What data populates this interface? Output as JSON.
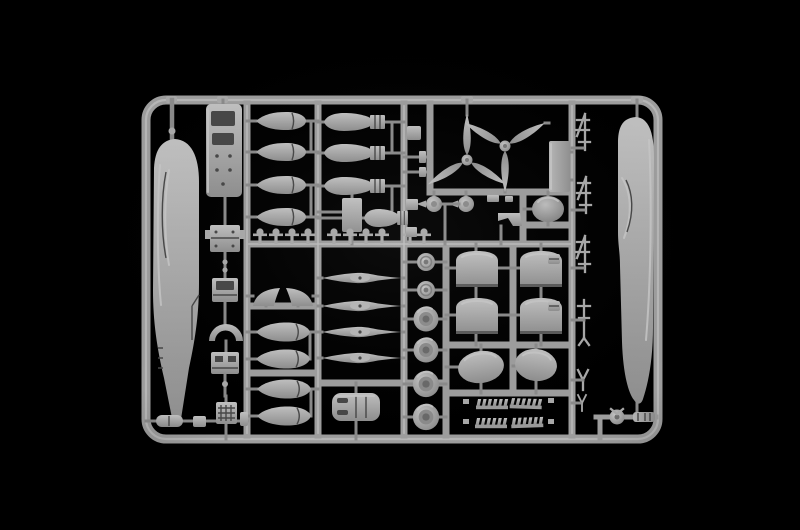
{
  "image": {
    "type": "product-photograph",
    "subject": "Injection-molded plastic model aircraft kit sprue (parts tree) in light gray styrene, photographed on a black background",
    "colors": {
      "bg": "#000000",
      "sprue": "#a8a8a8",
      "sprue-light": "#c6c6c6",
      "sprue-dark": "#7e7e7e",
      "runner": "#9d9d9d",
      "runner-light": "#bdbdbd",
      "runner-dark": "#8a8a8a",
      "detail": "#474747"
    }
  },
  "parts_inventory": [
    {
      "part": "fuselage half (left)",
      "quantity": 1
    },
    {
      "part": "fuselage half (right)",
      "quantity": 1
    },
    {
      "part": "cockpit floor",
      "quantity": 1
    },
    {
      "part": "cockpit bulkhead / seat / interior fitting",
      "quantity": 4
    },
    {
      "part": "bomb (plain)",
      "quantity": 4
    },
    {
      "part": "bomb with box tail fins",
      "quantity": 4
    },
    {
      "part": "drop tank",
      "quantity": 4
    },
    {
      "part": "bomb shackle / small fitting",
      "quantity": 10
    },
    {
      "part": "three-blade propeller",
      "quantity": 2
    },
    {
      "part": "propeller spinner with backplate",
      "quantity": 2
    },
    {
      "part": "engine nacelle half",
      "quantity": 4
    },
    {
      "part": "oval cowl panel",
      "quantity": 2
    },
    {
      "part": "engine cowling top",
      "quantity": 1
    },
    {
      "part": "main wheel",
      "quantity": 4
    },
    {
      "part": "wheel hub disc",
      "quantity": 2
    },
    {
      "part": "exhaust stack",
      "quantity": 4
    },
    {
      "part": "horizontal stabilizer half",
      "quantity": 2
    },
    {
      "part": "streamlined fairing",
      "quantity": 4
    },
    {
      "part": "antenna / strut small part",
      "quantity": 6
    },
    {
      "part": "tail wheel",
      "quantity": 1
    },
    {
      "part": "canopy / cowl dome",
      "quantity": 1
    },
    {
      "part": "access panel",
      "quantity": 1
    },
    {
      "part": "mounting plate",
      "quantity": 1
    },
    {
      "part": "small fitting on bottom rail",
      "quantity": 4
    }
  ]
}
